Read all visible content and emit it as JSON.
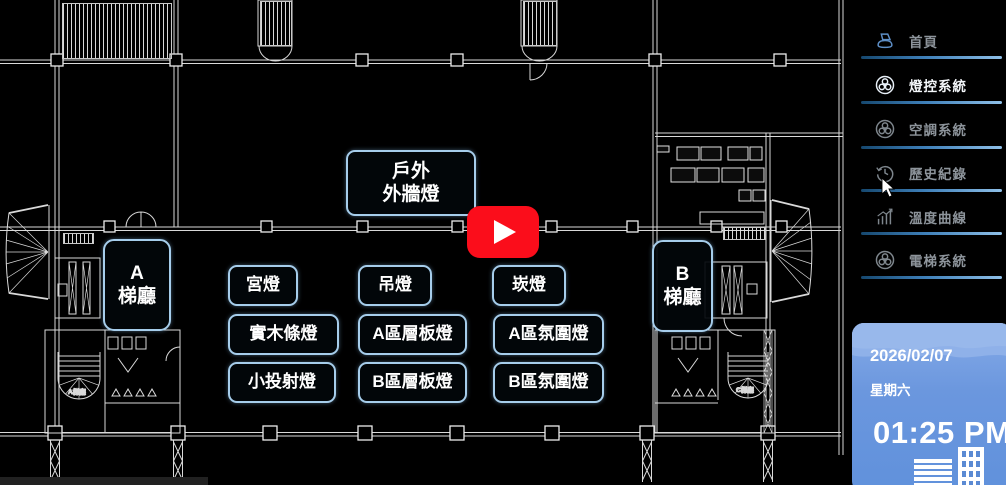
{
  "sidebar": {
    "items": [
      {
        "label": "首頁",
        "icon": "home-icon",
        "active": false
      },
      {
        "label": "燈控系統",
        "icon": "fan-icon",
        "active": true
      },
      {
        "label": "空調系統",
        "icon": "fan-icon",
        "active": false
      },
      {
        "label": "歷史紀錄",
        "icon": "history-icon",
        "active": false
      },
      {
        "label": "溫度曲線",
        "icon": "chart-icon",
        "active": false
      },
      {
        "label": "電梯系統",
        "icon": "fan-icon",
        "active": false
      }
    ]
  },
  "buttons": {
    "outdoor_line1": "戶外",
    "outdoor_line2": "外牆燈",
    "lobby_a_line1": "A",
    "lobby_a_line2": "梯廳",
    "lobby_b_line1": "B",
    "lobby_b_line2": "梯廳",
    "grid": [
      [
        "宮燈",
        "吊燈",
        "崁燈"
      ],
      [
        "實木條燈",
        "A區層板燈",
        "A區氛圍燈"
      ],
      [
        "小投射燈",
        "B區層板燈",
        "B區氛圍燈"
      ]
    ]
  },
  "clock": {
    "date": "2026/02/07",
    "weekday": "星期六",
    "time": "01:25 PM"
  },
  "plan": {
    "stair_label_a": "A梯廳",
    "stair_label_c": "C梯廳"
  },
  "icons": {
    "play": "youtube-play-icon",
    "cursor": "mouse-cursor"
  },
  "colors": {
    "button_border": "#a6cdeb",
    "sidebar_active_text": "#f5f8fb",
    "sidebar_inactive_text": "#8d949b",
    "nav_underline": "#3e7fb8",
    "clock_panel_blue": "#6b97de",
    "youtube_red": "#fb0d1b",
    "cad_line": "#d9d9d9"
  }
}
